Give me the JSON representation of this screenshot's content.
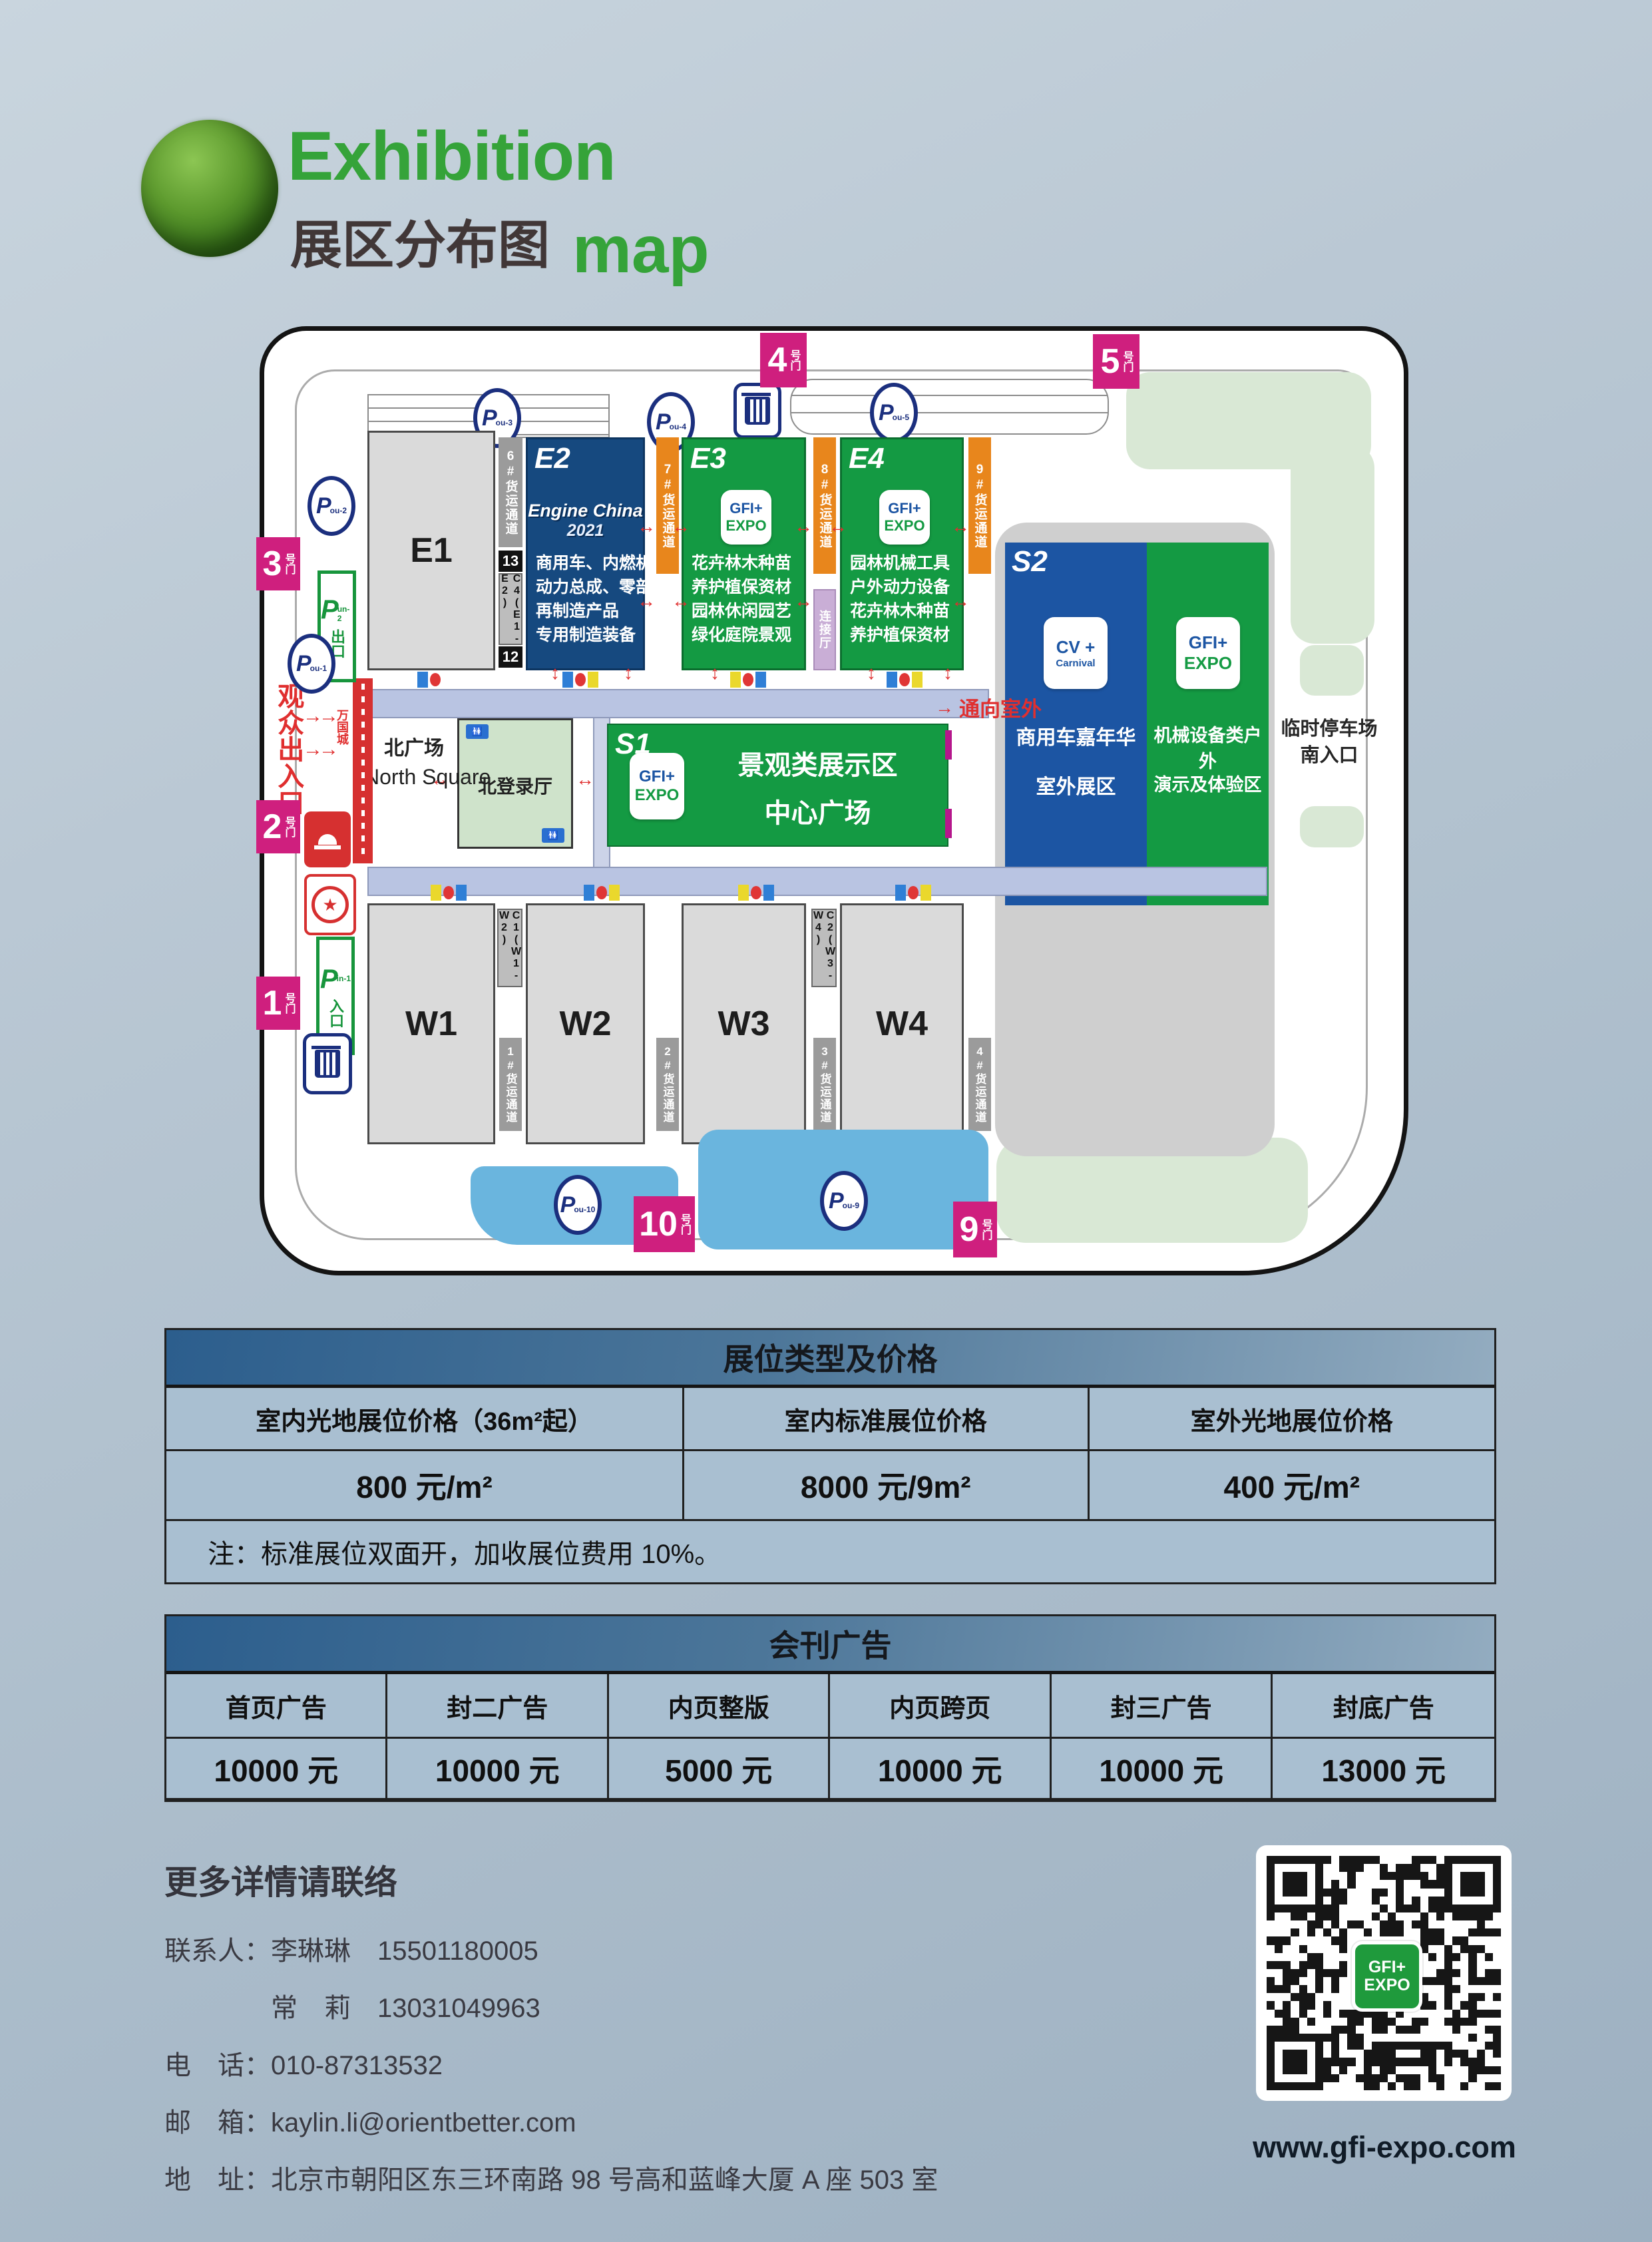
{
  "header": {
    "title_en": "Exhibition",
    "title_zh": "展区分布图",
    "title_map": "map"
  },
  "map": {
    "gates": [
      {
        "num": "4",
        "suffix": "号门"
      },
      {
        "num": "5",
        "suffix": "号门"
      },
      {
        "num": "3",
        "suffix": "号门"
      },
      {
        "num": "2",
        "suffix": "号门"
      },
      {
        "num": "1",
        "suffix": "号门"
      },
      {
        "num": "10",
        "suffix": "号门"
      },
      {
        "num": "9",
        "suffix": "号门"
      }
    ],
    "parking": {
      "p": "P",
      "subs": {
        "pou3": "ou-3",
        "pou4": "ou-4",
        "pou5": "ou-5",
        "pou2": "ou-2",
        "pou1": "ou-1",
        "pou10": "ou-10",
        "pou9": "ou-9"
      }
    },
    "p_signs": {
      "out_sub": "un-2",
      "out_label": "出口",
      "in_sub": "in-1",
      "in_label": "入口"
    },
    "halls": {
      "e1": "E1",
      "e2": {
        "name": "E2",
        "lines": [
          "商用车、内燃机",
          "动力总成、零部件",
          "再制造产品",
          "专用制造装备"
        ]
      },
      "e3": {
        "name": "E3",
        "lines": [
          "花卉林木种苗",
          "养护植保资材",
          "园林休闲园艺",
          "绿化庭院景观"
        ]
      },
      "e4": {
        "name": "E4",
        "lines": [
          "园林机械工具",
          "户外动力设备",
          "花卉林木种苗",
          "养护植保资材"
        ]
      },
      "s1": {
        "name": "S1",
        "lines": [
          "景观类展示区",
          "中心广场"
        ]
      },
      "s2": {
        "name": "S2",
        "blue_lines": [
          "商用车嘉年华",
          "室外展区"
        ],
        "green_lines": [
          "机械设备类户外",
          "演示及体验区"
        ]
      },
      "w1": "W1",
      "w2": "W2",
      "w3": "W3",
      "w4": "W4"
    },
    "engine_logo": {
      "l1": "Engine China",
      "l2": "2021"
    },
    "gfi_logo": {
      "l1": "GFI+",
      "l2": "EXPO"
    },
    "cv_logo": {
      "l1": "CV +",
      "l2": "Carnival"
    },
    "channels": {
      "c6": "6#货运通道",
      "c7": "7#货运通道",
      "c8": "8#货运通道",
      "c9": "9#货运通道",
      "f1": "1#货运通道",
      "f2": "2#货运通道",
      "f3": "3#货运通道",
      "f4": "4#货运通道"
    },
    "connectors": {
      "c4": "C4(E1-E2)",
      "t13": "13",
      "t12": "12",
      "c1": "C1(W1-W2)",
      "c2": "C2(W3-W4)",
      "link": "连接厅"
    },
    "labels": {
      "north_zh": "北广场",
      "north_en": "North Square",
      "north_hall": "北登录厅",
      "to_outdoor": "通向室外",
      "audience": "观众出入口",
      "banner": "万国城",
      "temp1": "临时停车场",
      "temp2": "南入口"
    }
  },
  "booth_table": {
    "title": "展位类型及价格",
    "headers": [
      "室内光地展位价格（36m²起）",
      "室内标准展位价格",
      "室外光地展位价格"
    ],
    "prices": [
      "800 元/m²",
      "8000 元/9m²",
      "400 元/m²"
    ],
    "note": "注：标准展位双面开，加收展位费用 10%。"
  },
  "ad_table": {
    "title": "会刊广告",
    "labels": [
      "首页广告",
      "封二广告",
      "内页整版",
      "内页跨页",
      "封三广告",
      "封底广告"
    ],
    "prices": [
      "10000 元",
      "10000 元",
      "5000 元",
      "10000 元",
      "10000 元",
      "13000 元"
    ]
  },
  "contact": {
    "heading": "更多详情请联络",
    "lines": [
      "联系人：李琳琳　15501180005",
      "　　　　常　莉　13031049963",
      "电　话：010-87313532",
      "邮　箱：kaylin.li@orientbetter.com",
      "地　址：北京市朝阳区东三环南路 98 号高和蓝峰大厦 A 座 503 室"
    ],
    "website": "www.gfi-expo.com"
  }
}
